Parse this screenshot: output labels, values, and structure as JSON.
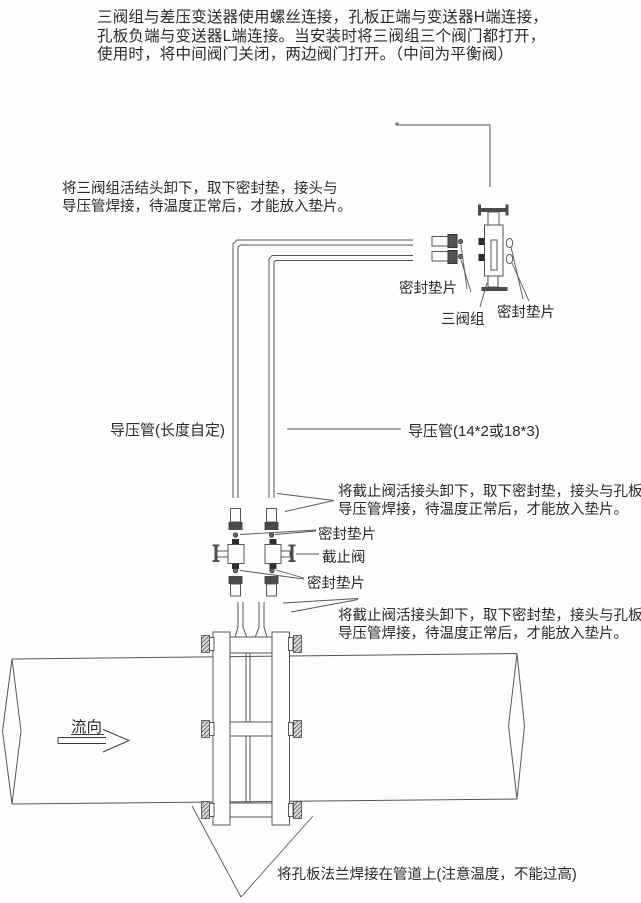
{
  "page": {
    "background_color": "#fdfdfd",
    "line_color": "#565656",
    "text_color": "#2b2b2b"
  },
  "notes": {
    "top_paragraph": {
      "lines": [
        "三阀组与差压变送器使用螺丝连接，孔板正端与变送器H端连接，",
        "孔板负端与变送器L端连接。当安装时将三阀组三个阀门都打开，",
        "使用时，将中间阀门关闭，两边阀门打开。（中间为平衡阀）"
      ]
    },
    "left_note": {
      "lines": [
        "将三阀组活结头卸下，取下密封垫，接头与",
        "导压管焊接，待温度正常后，才能放入垫片。"
      ]
    },
    "right_note_upper": {
      "lines": [
        "将截止阀活接头卸下，取下密封垫，接头与孔板",
        "导压管焊接，待温度正常后，才能放入垫片。"
      ]
    },
    "right_note_lower": {
      "lines": [
        "将截止阀活接头卸下，取下密封垫，接头与孔板",
        "导压管焊接，待温度正常后，才能放入垫片。"
      ]
    },
    "bottom_note": "将孔板法兰焊接在管道上(注意温度，不能过高)"
  },
  "labels": {
    "seal_gasket_left": "密封垫片",
    "three_valve_group": "三阀组",
    "seal_gasket_right": "密封垫片",
    "impulse_pipe_left": "导压管(长度自定)",
    "impulse_pipe_right": "导压管(14*2或18*3)",
    "seal_gasket_upper": "密封垫片",
    "stop_valve": "截止阀",
    "seal_gasket_lower": "密封垫片",
    "flow_direction": "流向"
  }
}
